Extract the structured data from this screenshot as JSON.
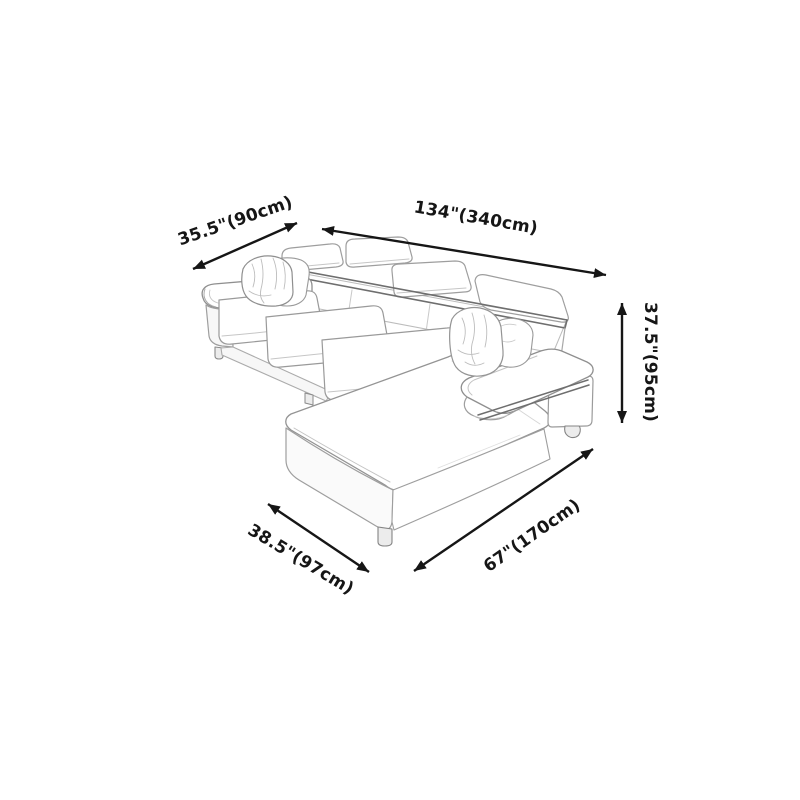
{
  "window": {
    "width": 800,
    "height": 800,
    "background": "#ffffff"
  },
  "diagram": {
    "kind": "product dimension diagram",
    "subject": "L-shaped sectional sofa line-art sketch with left armrest, three seat cushions, adjustable headrests, headrest rail, throw pillows, corner chaise and right armrest",
    "dimensions": [
      {
        "id": "back-depth",
        "label": "35.5\"(90cm)",
        "inches": 35.5,
        "cm": 90
      },
      {
        "id": "total-length",
        "label": "134\"(340cm)",
        "inches": 134,
        "cm": 340
      },
      {
        "id": "height",
        "label": "37.5\"(95cm)",
        "inches": 37.5,
        "cm": 95
      },
      {
        "id": "front-width",
        "label": "38.5\"(97cm)",
        "inches": 38.5,
        "cm": 97
      },
      {
        "id": "chaise-length",
        "label": "67\"(170cm)",
        "inches": 67,
        "cm": 170
      }
    ],
    "colors": {
      "background": "#ffffff",
      "arrow": "#161616",
      "label_text": "#161616",
      "sketch_line": "#9b9b9b",
      "sketch_line_dark": "#6e6e6e",
      "sketch_line_light": "#c6c6c6"
    }
  }
}
